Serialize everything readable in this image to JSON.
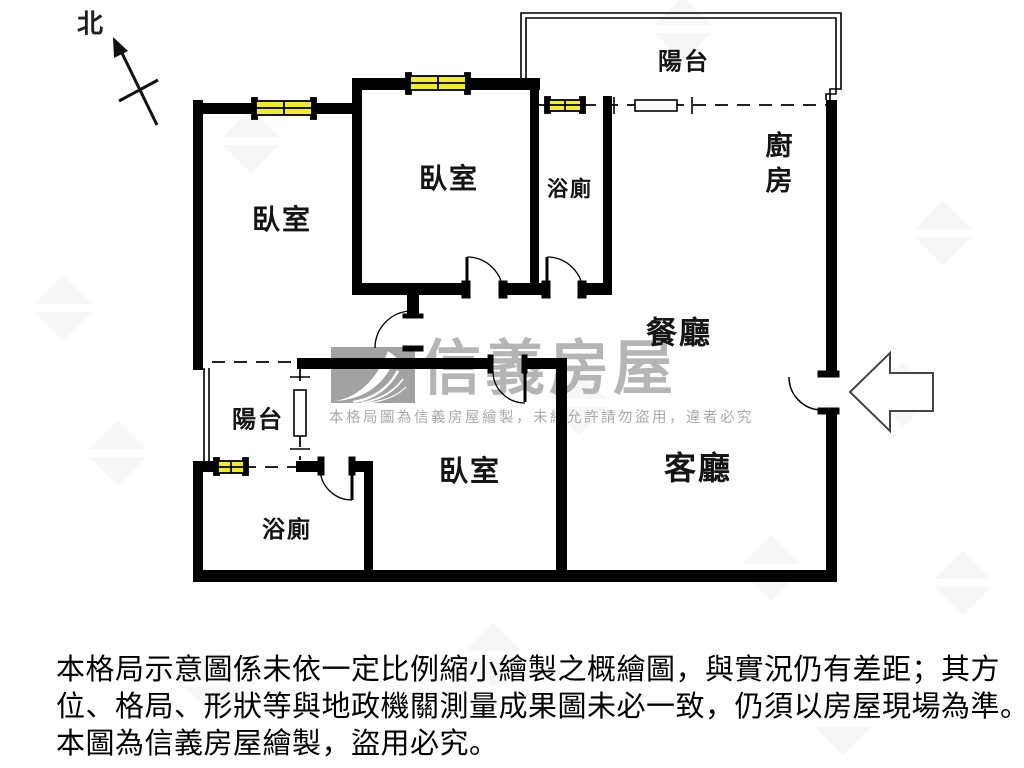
{
  "compass": {
    "label": "北"
  },
  "floorplan": {
    "wall_color": "#000000",
    "window_color": "#f0e93c",
    "rooms": [
      {
        "id": "balcony-top",
        "label": "陽台"
      },
      {
        "id": "kitchen",
        "label": "廚房"
      },
      {
        "id": "bedroom-left",
        "label": "臥室"
      },
      {
        "id": "bedroom-middle",
        "label": "臥室"
      },
      {
        "id": "bathroom-top",
        "label": "浴廁"
      },
      {
        "id": "dining",
        "label": "餐廳"
      },
      {
        "id": "living",
        "label": "客廳"
      },
      {
        "id": "bedroom-bottom",
        "label": "臥室"
      },
      {
        "id": "balcony-left",
        "label": "陽台"
      },
      {
        "id": "bathroom-bottom",
        "label": "浴廁"
      }
    ]
  },
  "watermark": {
    "brand": "信義房屋",
    "notice": "本格局圖為信義房屋繪製，未經允許請勿盜用，違者必究",
    "color": "#b5b5b5"
  },
  "disclaimer": {
    "lines": [
      "本格局示意圖係未依一定比例縮小繪製之概繪圖，與實況仍有差距；其方",
      "位、格局、形狀等與地政機關測量成果圖未必一致，仍須以房屋現場為準。",
      "本圖為信義房屋繪製，盜用必究。"
    ]
  }
}
